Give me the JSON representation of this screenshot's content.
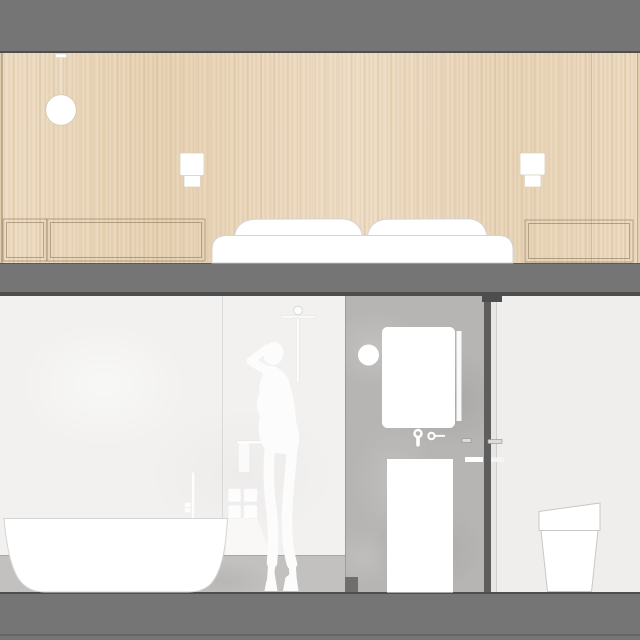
{
  "drawing": {
    "type": "interior elevation / section",
    "upper_room": "bedroom",
    "lower_room": "bathroom"
  },
  "colors": {
    "ceiling_band": "#757575",
    "band_shadow": "#4e4e4e",
    "slab_top": "#5a5a5a",
    "floor_slab": "#757575",
    "wood_base": "#ebd8bd",
    "wall_light": "#f2f1f0",
    "wall_lower": "#c3c1c0",
    "concrete": "#b7b5b3",
    "partition": "#5d5d5d",
    "reveal": "#e7e6e5",
    "right_wall": "#efeeed",
    "fixture_outline": "#d4d4d4",
    "silhouette": "#fcfcfc"
  },
  "bedroom": {
    "objects": [
      "pendant-light",
      "wall-sconce-left",
      "wall-sconce-right",
      "headboard-panel-small",
      "headboard-panel-long",
      "headboard-panel-right",
      "bed-mattress",
      "pillow-left",
      "pillow-right"
    ]
  },
  "bathroom": {
    "objects": [
      "freestanding-bathtub",
      "floor-tub-filler",
      "bath-accessories",
      "shower-column",
      "grab-bar",
      "towel",
      "person-silhouette",
      "round-wall-lamp",
      "mirror",
      "mirror-light-strip",
      "wall-tap",
      "wall-knob",
      "shelf-strip-left",
      "shelf-strip-right",
      "washbasin-column",
      "partition-wall",
      "toilet"
    ]
  }
}
